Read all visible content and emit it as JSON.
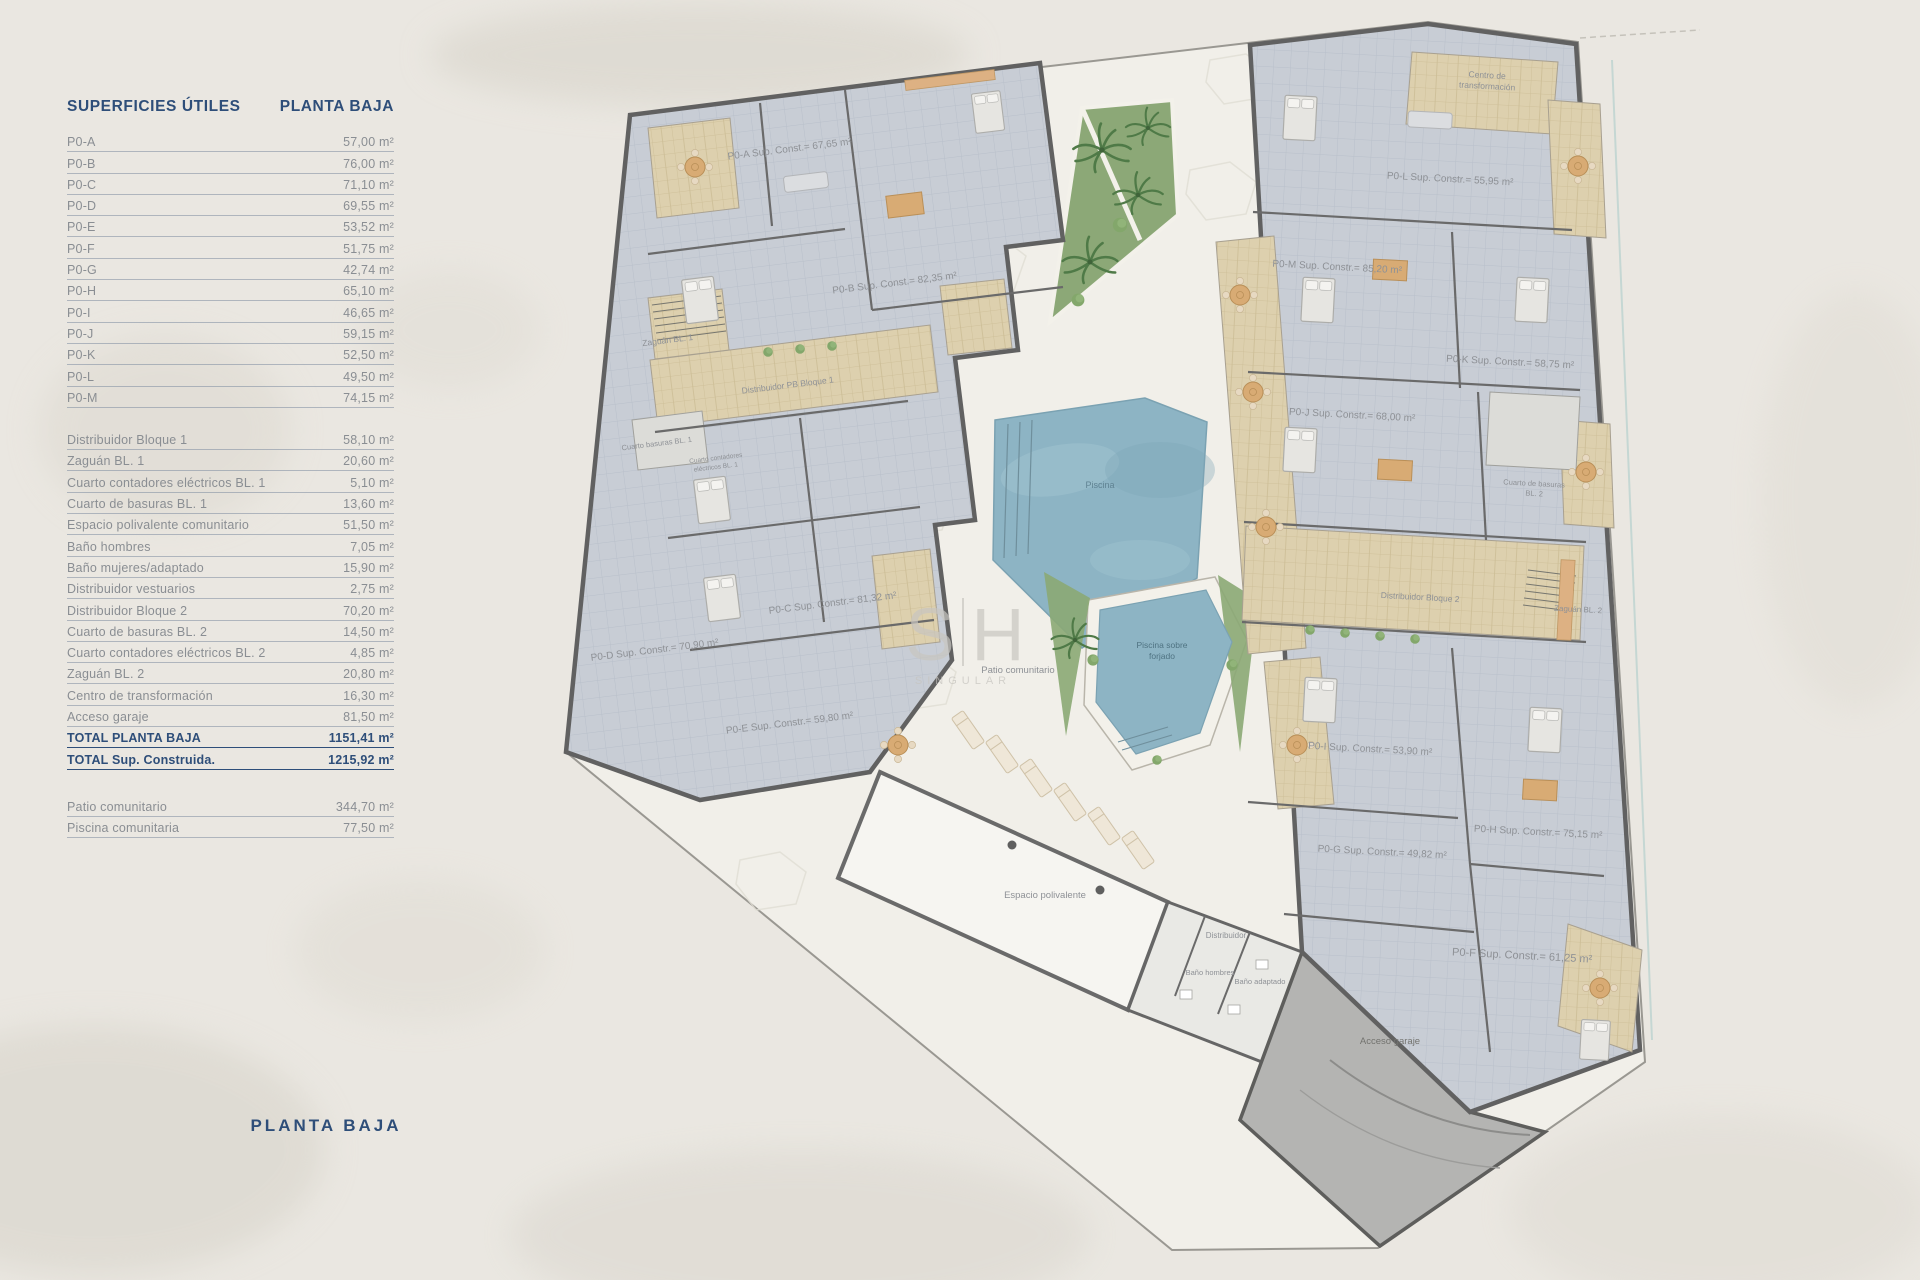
{
  "page": {
    "bottom_title": "PLANTA BAJA"
  },
  "surfaces": {
    "title": "SUPERFICIES ÚTILES",
    "subtitle": "PLANTA BAJA",
    "apartments": [
      {
        "label": "P0-A",
        "value": "57,00 m²"
      },
      {
        "label": "P0-B",
        "value": "76,00 m²"
      },
      {
        "label": "P0-C",
        "value": "71,10 m²"
      },
      {
        "label": "P0-D",
        "value": "69,55 m²"
      },
      {
        "label": "P0-E",
        "value": "53,52 m²"
      },
      {
        "label": "P0-F",
        "value": "51,75 m²"
      },
      {
        "label": "P0-G",
        "value": "42,74 m²"
      },
      {
        "label": "P0-H",
        "value": "65,10 m²"
      },
      {
        "label": "P0-I",
        "value": "46,65 m²"
      },
      {
        "label": "P0-J",
        "value": "59,15 m²"
      },
      {
        "label": "P0-K",
        "value": "52,50 m²"
      },
      {
        "label": "P0-L",
        "value": "49,50 m²"
      },
      {
        "label": "P0-M",
        "value": "74,15 m²"
      }
    ],
    "common": [
      {
        "label": "Distribuidor Bloque 1",
        "value": "58,10 m²"
      },
      {
        "label": "Zaguán BL. 1",
        "value": "20,60 m²"
      },
      {
        "label": "Cuarto contadores eléctricos BL. 1",
        "value": "5,10 m²"
      },
      {
        "label": "Cuarto de basuras BL. 1",
        "value": "13,60 m²"
      },
      {
        "label": "Espacio polivalente comunitario",
        "value": "51,50 m²"
      },
      {
        "label": "Baño hombres",
        "value": "7,05 m²"
      },
      {
        "label": "Baño mujeres/adaptado",
        "value": "15,90 m²"
      },
      {
        "label": "Distribuidor vestuarios",
        "value": "2,75 m²"
      },
      {
        "label": "Distribuidor Bloque 2",
        "value": "70,20 m²"
      },
      {
        "label": "Cuarto de basuras BL. 2",
        "value": "14,50 m²"
      },
      {
        "label": "Cuarto contadores eléctricos BL. 2",
        "value": "4,85 m²"
      },
      {
        "label": "Zaguán BL. 2",
        "value": "20,80 m²"
      },
      {
        "label": "Centro de transformación",
        "value": "16,30 m²"
      },
      {
        "label": "Acceso garaje",
        "value": "81,50 m²"
      },
      {
        "label": "TOTAL PLANTA BAJA",
        "value": "1151,41 m²",
        "total": true
      },
      {
        "label": "TOTAL Sup. Construida.",
        "value": "1215,92 m²",
        "total": true
      }
    ],
    "outdoor": [
      {
        "label": "Patio comunitario",
        "value": "344,70 m²"
      },
      {
        "label": "Piscina comunitaria",
        "value": "77,50 m²"
      }
    ]
  },
  "plan": {
    "watermark": {
      "letter1": "S",
      "letter2": "H",
      "subtext": "SINGULAR"
    },
    "labels": {
      "p0a": "P0-A Sup. Const.= 67,65 m²",
      "p0b": "P0-B Sup. Const.= 82,35 m²",
      "p0c": "P0-C Sup. Constr.= 81,32 m²",
      "p0d": "P0-D Sup. Constr.= 70,90 m²",
      "p0e": "P0-E Sup. Constr.= 59,80 m²",
      "p0f": "P0-F Sup. Constr.= 61,25 m²",
      "p0g": "P0-G Sup. Constr.= 49,82 m²",
      "p0h": "P0-H Sup. Constr.= 75,15 m²",
      "p0i": "P0-I Sup. Constr.= 53,90 m²",
      "p0j": "P0-J Sup. Constr.= 68,00 m²",
      "p0k": "P0-K Sup. Constr.= 58,75 m²",
      "p0l": "P0-L Sup. Constr.= 55,95 m²",
      "p0m": "P0-M Sup. Constr.= 85,20 m²",
      "zaguan1": "Zaguán BL. 1",
      "distribuidor_pb1": "Distribuidor PB Bloque 1",
      "basuras1": "Cuarto basuras BL. 1",
      "contadores1_l1": "Cuarto contadores",
      "contadores1_l2": "eléctricos BL. 1",
      "centro_l1": "Centro de",
      "centro_l2": "transformación",
      "basuras2_l1": "Cuarto de basuras",
      "basuras2_l2": "BL. 2",
      "distribuidor2": "Distribuidor Bloque 2",
      "zaguan2": "Zaguán BL. 2",
      "patio": "Patio comunitario",
      "piscina": "Piscina",
      "piscina_forjado_l1": "Piscina sobre",
      "piscina_forjado_l2": "forjado",
      "espacio": "Espacio polivalente",
      "distribuidor_aseos": "Distribuidor",
      "bano_hombres": "Baño hombres",
      "bano_adaptado": "Baño adaptado",
      "acceso": "Acceso garaje"
    }
  }
}
